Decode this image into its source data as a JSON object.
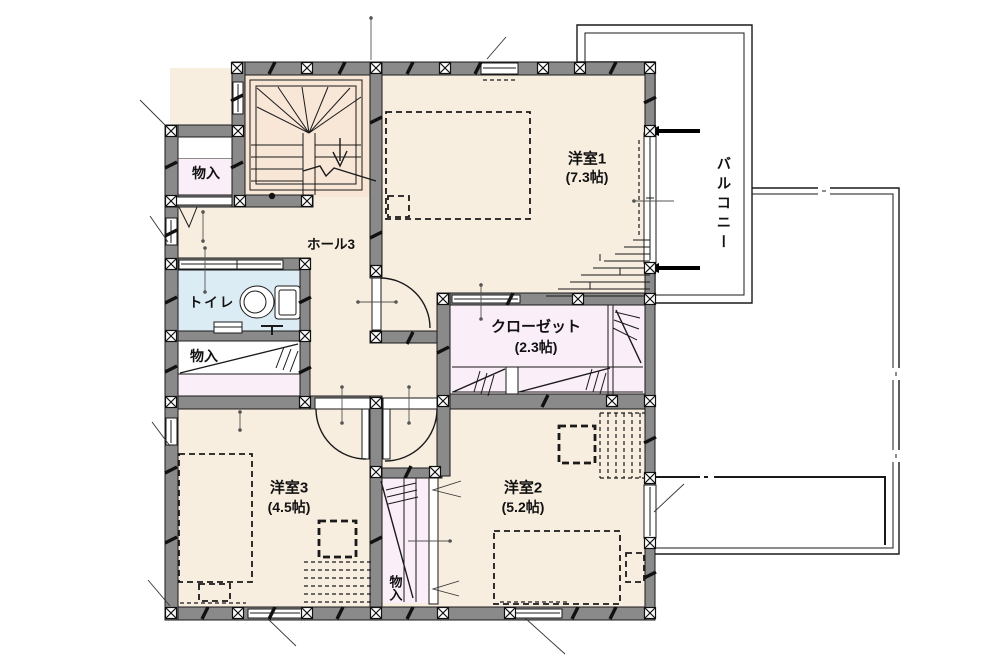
{
  "plan_type": "floor-plan",
  "rooms": {
    "room1": {
      "name": "洋室1",
      "size": "(7.3帖)"
    },
    "room2": {
      "name": "洋室2",
      "size": "(5.2帖)"
    },
    "room3": {
      "name": "洋室3",
      "size": "(4.5帖)"
    },
    "closet": {
      "name": "クローゼット",
      "size": "(2.3帖)"
    },
    "hall": {
      "name": "ホール3"
    },
    "toilet": {
      "name": "トイレ"
    },
    "storage_top_left": {
      "name": "物入"
    },
    "storage_mid_left": {
      "name": "物入"
    },
    "storage_bottom_mid": {
      "name": "物入"
    },
    "balcony": {
      "name": "バルコニー"
    }
  },
  "colors": {
    "wall": "#8a8a8a",
    "room_floor": "#f7eee0",
    "stairs_floor": "#f8e6d7",
    "storage_floor": "#faeef8",
    "toilet_floor": "#dcecf5",
    "outline": "#1a1a1a",
    "background": "#ffffff"
  }
}
